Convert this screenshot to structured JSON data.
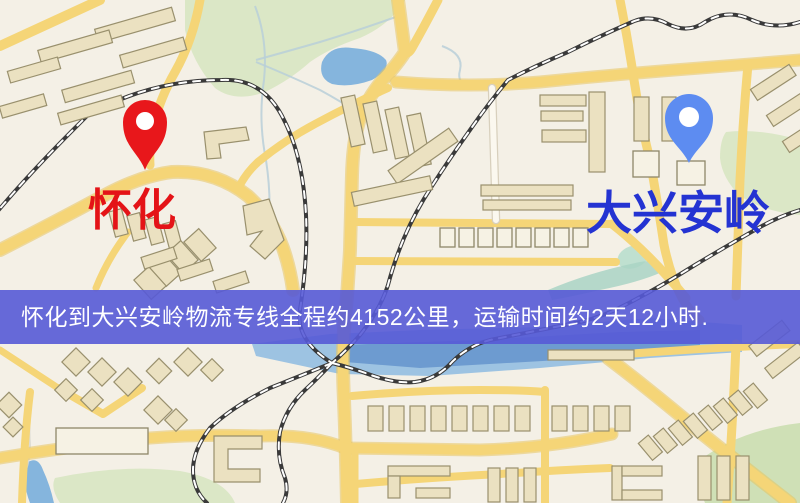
{
  "map": {
    "type": "street-map",
    "base_color": "#f4f0e6",
    "road_color": "#f5d577",
    "water_color": "#85b5dd",
    "green_color": "#dbe7c6",
    "building_color": "#ebe1c1"
  },
  "markers": {
    "origin": {
      "label": "怀化",
      "pin_color": "#e8171b",
      "label_color": "#e41317",
      "icon": "map-pin"
    },
    "destination": {
      "label": "大兴安岭",
      "pin_color": "#5d8cf1",
      "label_color": "#2433d2",
      "icon": "map-pin"
    }
  },
  "banner": {
    "text": "怀化到大兴安岭物流专线全程约4152公里，运输时间约2天12小时.",
    "bg_color": "#565ad6",
    "text_color": "#ffffff",
    "distance_km": "4152",
    "duration": "2天12小时"
  }
}
